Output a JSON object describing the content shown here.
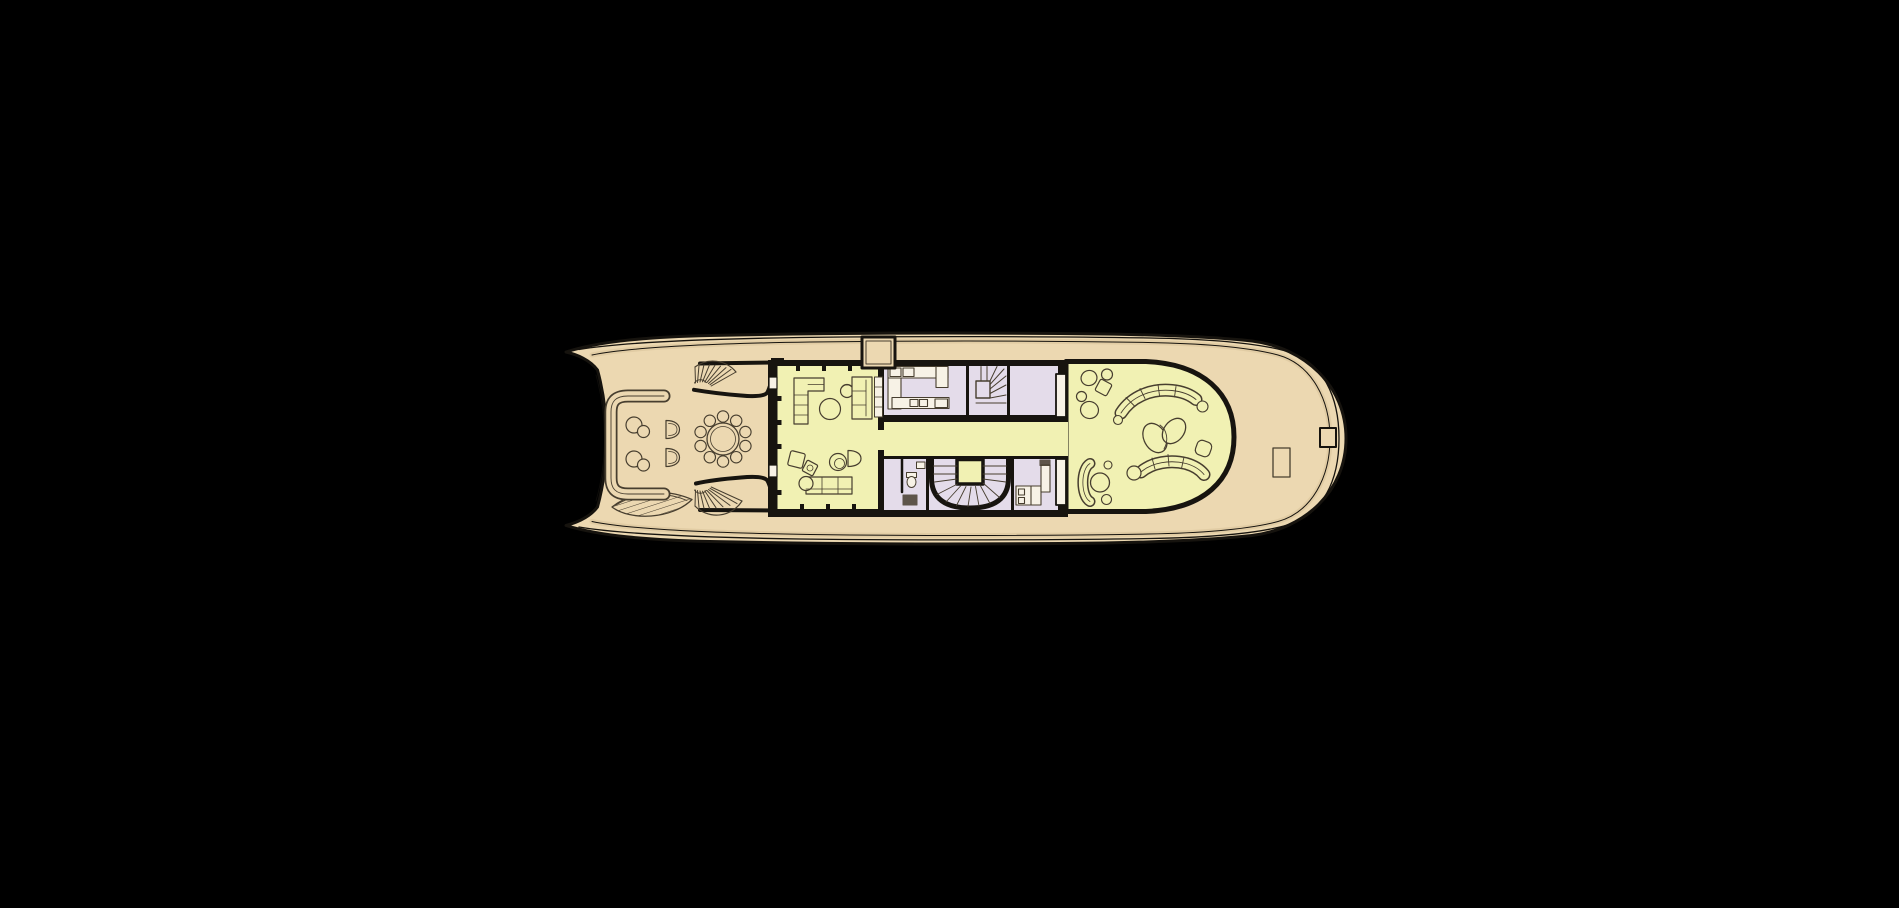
{
  "description": "Yacht deck floor plan, top view, on black background",
  "colors": {
    "background": "#000000",
    "hullline": "#16130e",
    "deck": "#ecd8b1",
    "deckshade": "#d9c299",
    "lounge": "#f1f1b3",
    "service": "#e4dcea",
    "wall": "#17140f",
    "furn": "#473e2f",
    "fixture": "#f7f2e6"
  },
  "zones": [
    {
      "name": "exterior-deck",
      "color": "#ecd8b1"
    },
    {
      "name": "lounge-areas",
      "color": "#f1f1b3"
    },
    {
      "name": "service-areas",
      "color": "#e4dcea"
    }
  ]
}
